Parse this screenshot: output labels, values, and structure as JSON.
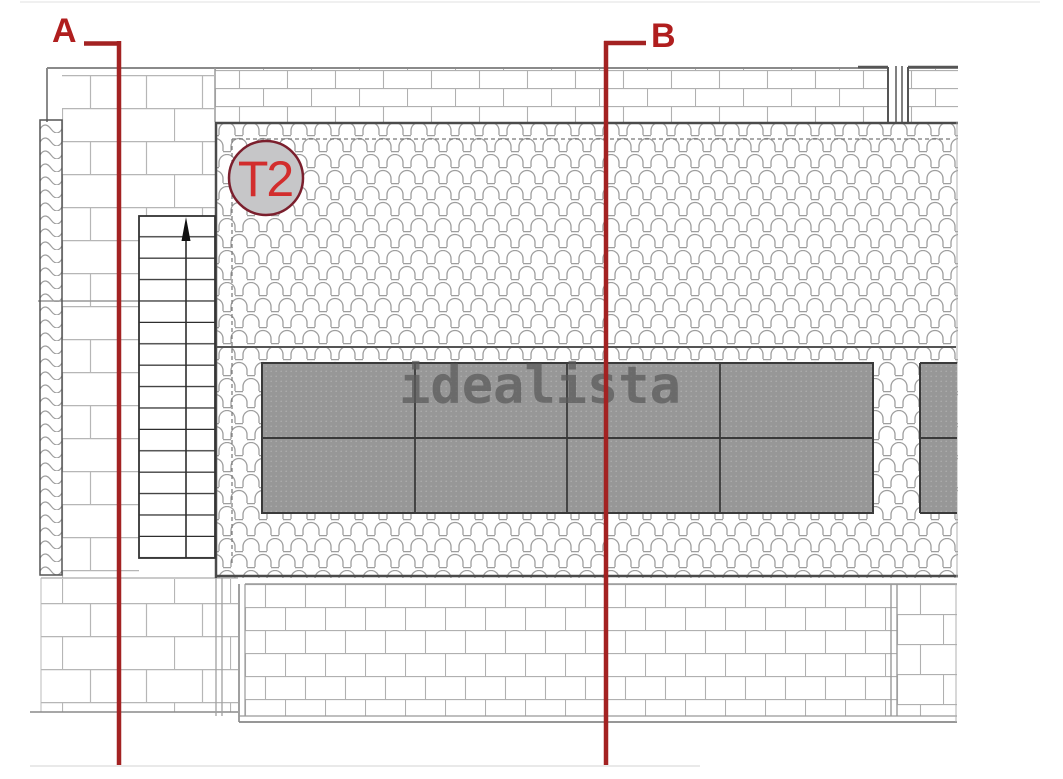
{
  "drawing": {
    "unit_badge": "T2",
    "watermark": "idealista",
    "sections": {
      "a_label": "A",
      "b_label": "B"
    },
    "solar_array": {
      "rows": 2,
      "full_columns": 4,
      "partial_columns": 1
    },
    "colors": {
      "section_line": "#a32222",
      "section_label": "#b01e1e",
      "badge_fill": "#c6c6c8",
      "badge_border": "#7b1f2d",
      "badge_text": "#d22d2d",
      "panel_fill": "#979797",
      "panel_border": "#3a3a3a",
      "roof_border": "#4a4a4a",
      "hatch_line": "#9e9e9e",
      "brick_line": "#b6b6b6",
      "watermark_color": "#5a5a5a"
    }
  }
}
